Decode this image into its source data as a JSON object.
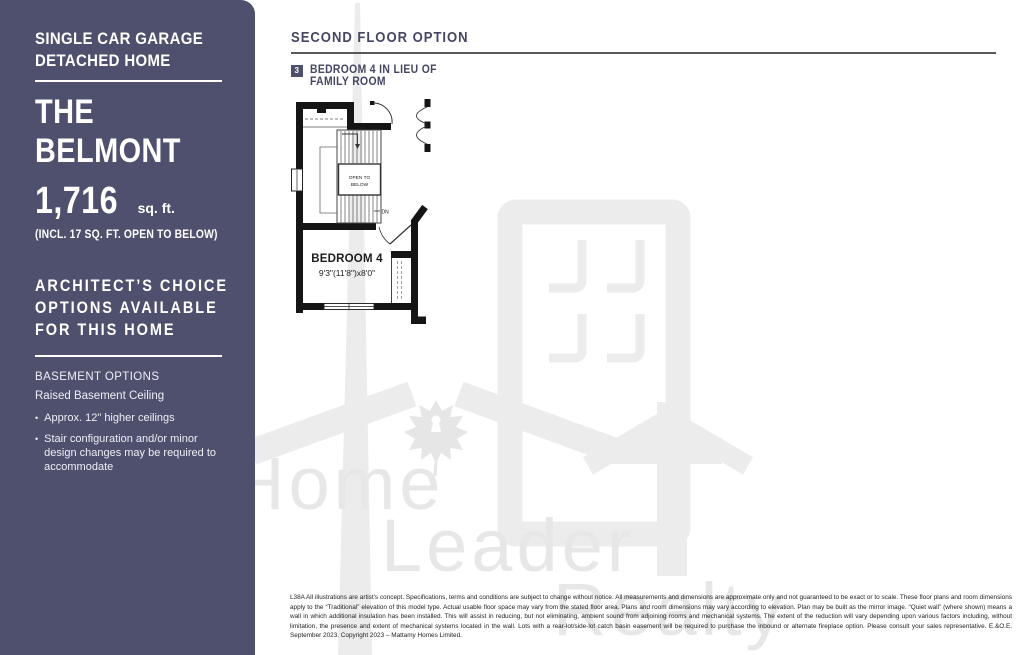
{
  "colors": {
    "sidebar_bg": "#4f506e",
    "accent_text": "#454663",
    "watermark_gray": "#ececec",
    "rule_gray": "#58595b"
  },
  "sidebar": {
    "subtitle_line1": "SINGLE CAR GARAGE",
    "subtitle_line2": "DETACHED HOME",
    "title_line1": "THE",
    "title_line2": "BELMONT",
    "sqft_value": "1,716",
    "sqft_unit": "sq. ft.",
    "sqft_note": "(INCL. 17 SQ. FT. OPEN TO BELOW)",
    "architects_choice_line1": "ARCHITECT’S CHOICE",
    "architects_choice_line2": "OPTIONS AVAILABLE",
    "architects_choice_line3": "FOR THIS HOME",
    "basement_heading": "BASEMENT OPTIONS",
    "basement_subheading": "Raised Basement Ceiling",
    "bullet1": "Approx. 12\" higher ceilings",
    "bullet2": "Stair configuration and/or minor design changes may be required to accommodate"
  },
  "main": {
    "header": "SECOND FLOOR OPTION",
    "option_badge": "3",
    "option_line1": "BEDROOM 4 IN LIEU OF",
    "option_line2": "FAMILY ROOM"
  },
  "floorplan": {
    "open_to_below_line1": "OPEN TO",
    "open_to_below_line2": "BELOW",
    "down_label": "DN",
    "room_label": "BEDROOM 4",
    "room_dimensions": "9'3\"(11'8\")x8'0\""
  },
  "watermark": {
    "word1": "Home",
    "word2": "Leader",
    "word3": "Realty"
  },
  "legal_text": "L38A All illustrations are artist’s concept. Specifications, terms and conditions are subject to change without notice. All measurements and dimensions are approximate only and not guaranteed to be exact or to scale. These floor plans and room dimensions apply to the “Traditional” elevation of this model type. Actual usable floor space may vary from the stated floor area. Plans and room dimensions may vary according to elevation. Plan may be built as the mirror image. “Quiet wall” (where shown) means a wall in which additional insulation has been installed. This will assist in reducing, but not eliminating, ambient sound from adjoining rooms and mechanical systems. The extent of the reduction will vary depending upon various factors including, without limitation, the presence and extent of mechanical systems located in the wall. Lots with a rear-lot/side-lot catch basin easement will be required to purchase the inbound or alternate fireplace option. Please consult your sales representative. E.&O.E. September 2023. Copyright 2023 – Mattamy Homes Limited."
}
